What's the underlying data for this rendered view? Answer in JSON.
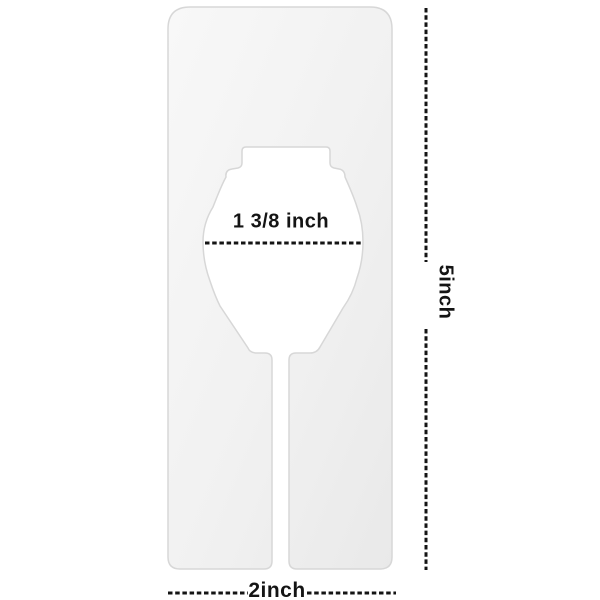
{
  "diagram": {
    "background_color": "#ffffff",
    "annotation_color": "#141414",
    "plate_fill_light": "#f8f8f8",
    "plate_fill_dark": "#e9e9e9",
    "plate_edge_color": "#d7d7d7",
    "labels": {
      "hole_diameter": "1 3/8 inch",
      "height": "5inch",
      "width": "2inch"
    }
  }
}
